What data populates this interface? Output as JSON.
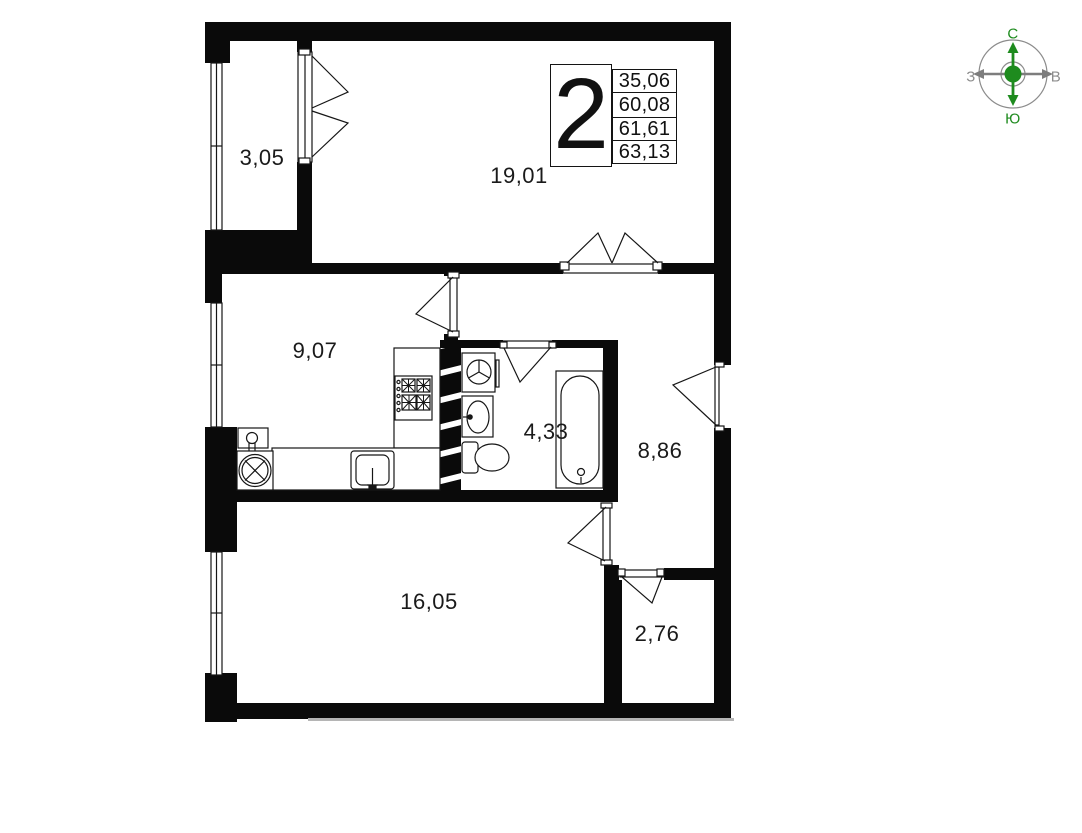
{
  "legend": {
    "rooms_count": "2",
    "values": [
      "35,06",
      "60,08",
      "61,61",
      "63,13"
    ]
  },
  "rooms": {
    "balcony": {
      "area": "3,05"
    },
    "living_room": {
      "area": "19,01"
    },
    "kitchen": {
      "area": "9,07"
    },
    "bathroom": {
      "area": "4,33"
    },
    "hallway": {
      "area": "8,86"
    },
    "bedroom": {
      "area": "16,05"
    },
    "wardrobe": {
      "area": "2,76"
    }
  },
  "compass": {
    "north": "С",
    "south": "Ю",
    "west": "З",
    "east": "В"
  },
  "icons": [
    "compass-rose-icon",
    "bathtub-icon",
    "toilet-icon",
    "bathroom-sink-icon",
    "washing-machine-icon",
    "washer-drum-icon",
    "kitchen-sink-icon",
    "stove-icon",
    "radiator-icon",
    "ventilation-shaft-icon",
    "window-icon",
    "door-swing-icon"
  ],
  "colors": {
    "wall": "#0a0a0a",
    "line": "#161616",
    "compass_green": "#1e8b1e",
    "compass_gray": "#8c8c8c",
    "background": "#ffffff"
  }
}
